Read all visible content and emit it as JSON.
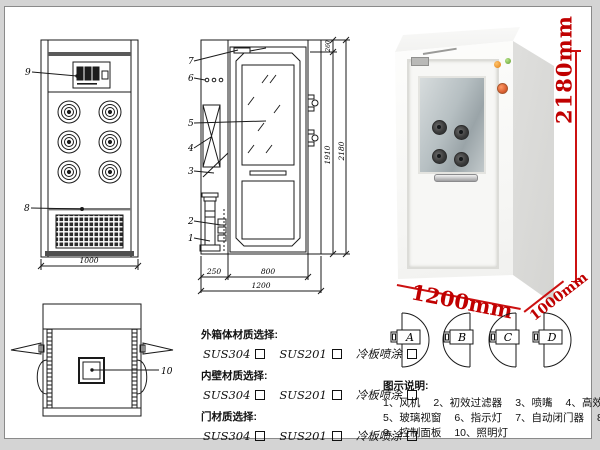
{
  "front_view": {
    "part9": "9",
    "part8": "8",
    "dim_width": "1000"
  },
  "side_view": {
    "labels": [
      "7",
      "6",
      "5",
      "4",
      "3",
      "2",
      "1"
    ],
    "dim_top": "260",
    "dim_door_height": "1910",
    "dim_total_height": "2180",
    "dim_left": "250",
    "dim_door_width": "800",
    "dim_total_width": "1200"
  },
  "top_view": {
    "part10": "10"
  },
  "photo": {
    "dim_height": "2180mm",
    "dim_width": "1200mm",
    "dim_depth": "1000mm",
    "dim_color": "#cc0000"
  },
  "door_options": {
    "a": "A",
    "b": "B",
    "c": "C",
    "d": "D"
  },
  "materials": {
    "groups": [
      {
        "title": "外箱体材质选择:",
        "options": [
          "SUS304",
          "SUS201",
          "冷板喷涂"
        ]
      },
      {
        "title": "内壁材质选择:",
        "options": [
          "SUS304",
          "SUS201",
          "冷板喷涂"
        ]
      },
      {
        "title": "门材质选择:",
        "options": [
          "SUS304",
          "SUS201",
          "冷板喷涂"
        ]
      }
    ]
  },
  "legend": {
    "title": "图示说明:",
    "items": [
      "1、风机",
      "2、初效过滤器",
      "3、喷嘴",
      "4、高效过滤器",
      "5、玻璃视窗",
      "6、指示灯",
      "7、自动闭门器",
      "8、红外线感应器",
      "9、控制面板",
      "10、照明灯"
    ]
  }
}
